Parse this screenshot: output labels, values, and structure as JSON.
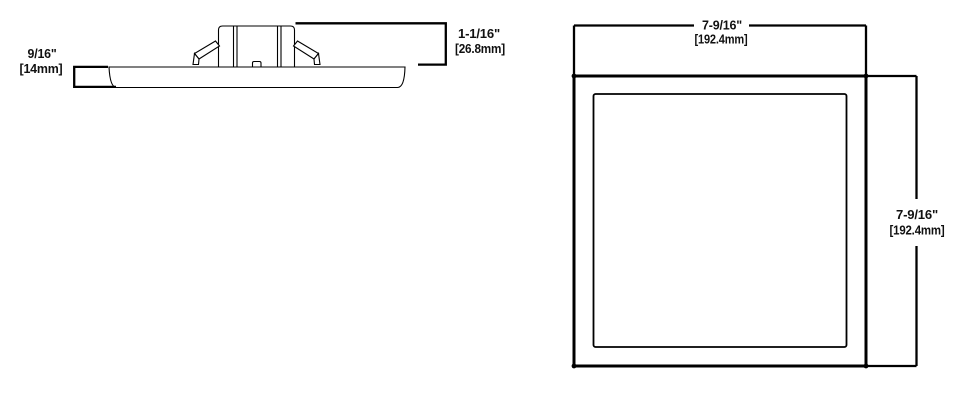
{
  "drawing": {
    "side_view": {
      "thickness_dim": {
        "inches": "9/16\"",
        "mm": "[14mm]"
      },
      "box_height_dim": {
        "inches": "1-1/16\"",
        "mm": "[26.8mm]"
      }
    },
    "front_view": {
      "width_dim": {
        "inches": "7-9/16\"",
        "mm": "[192.4mm]"
      },
      "height_dim": {
        "inches": "7-9/16\"",
        "mm": "[192.4mm]"
      }
    },
    "colors": {
      "line": "#000000",
      "text": "#111111",
      "background": "#ffffff"
    }
  }
}
